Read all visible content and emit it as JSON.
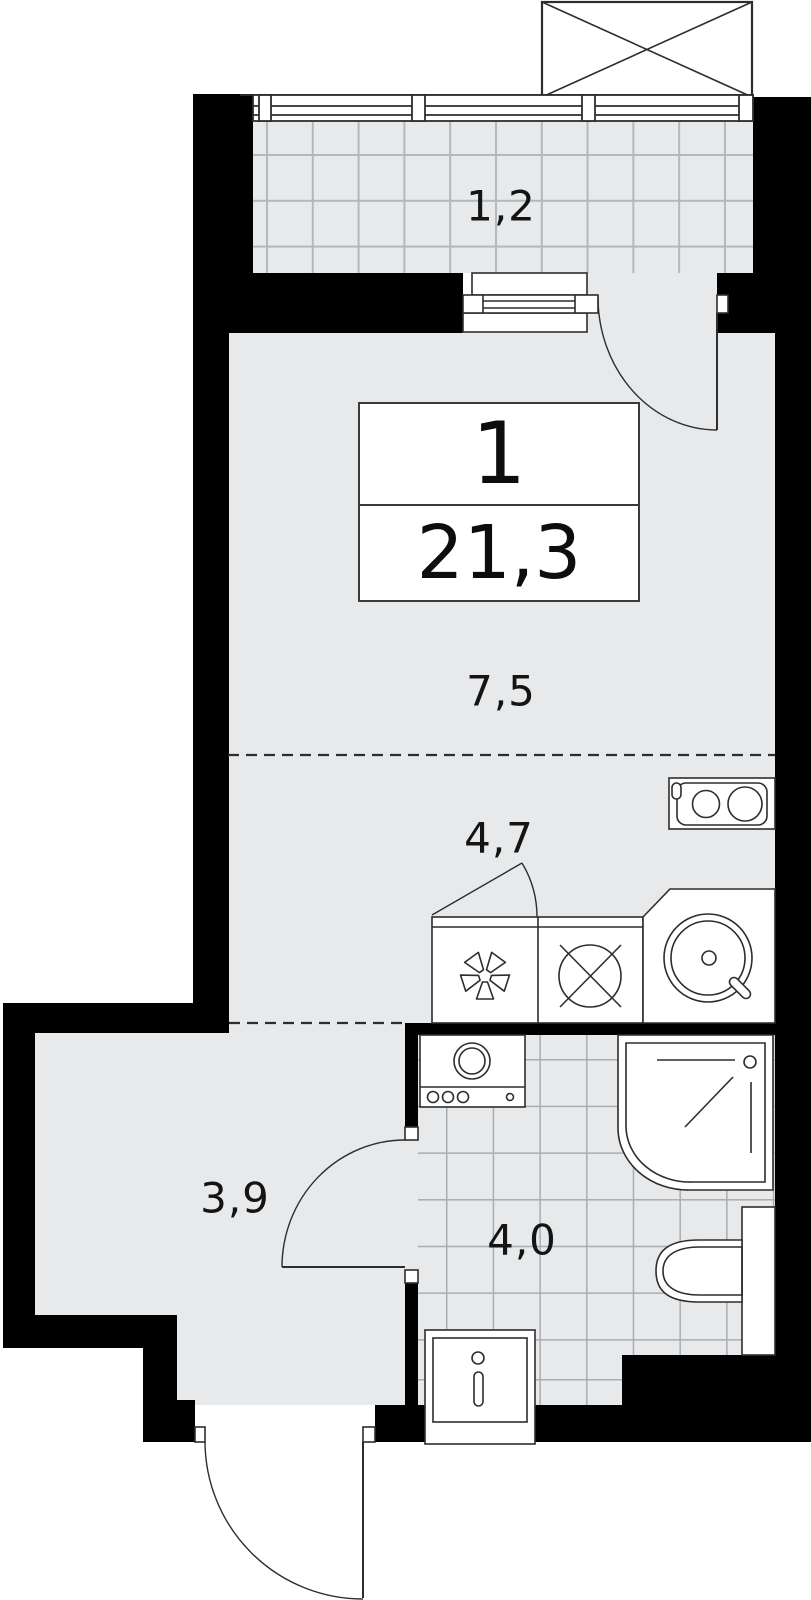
{
  "document": {
    "type": "apartment-floor-plan",
    "description": "Studio apartment plan with balcony, combined living/kitchen zone, hallway and bathroom"
  },
  "info_box": {
    "rooms_count": "1",
    "total_area": "21,3"
  },
  "room_areas": {
    "balcony": "1,2",
    "living_room": "7,5",
    "kitchen": "4,7",
    "hallway": "3,9",
    "bathroom": "4,0"
  },
  "fixtures": [
    "shaft-box-icon",
    "balcony-glazing-icon",
    "balcony-door-icon",
    "stove-icon",
    "fan-symbol-icon",
    "hob-cross-icon",
    "kitchen-sink-icon",
    "washing-machine-icon",
    "shower-cabin-icon",
    "toilet-icon",
    "washbasin-icon",
    "entrance-door-icon",
    "bathroom-door-icon"
  ],
  "colors": {
    "wall": "#000000",
    "floor": "#e7e9eb",
    "tile_line": "#aeb3b6",
    "fixture_outline": "#2d2d2d",
    "paper": "#ffffff",
    "text": "#141414"
  }
}
